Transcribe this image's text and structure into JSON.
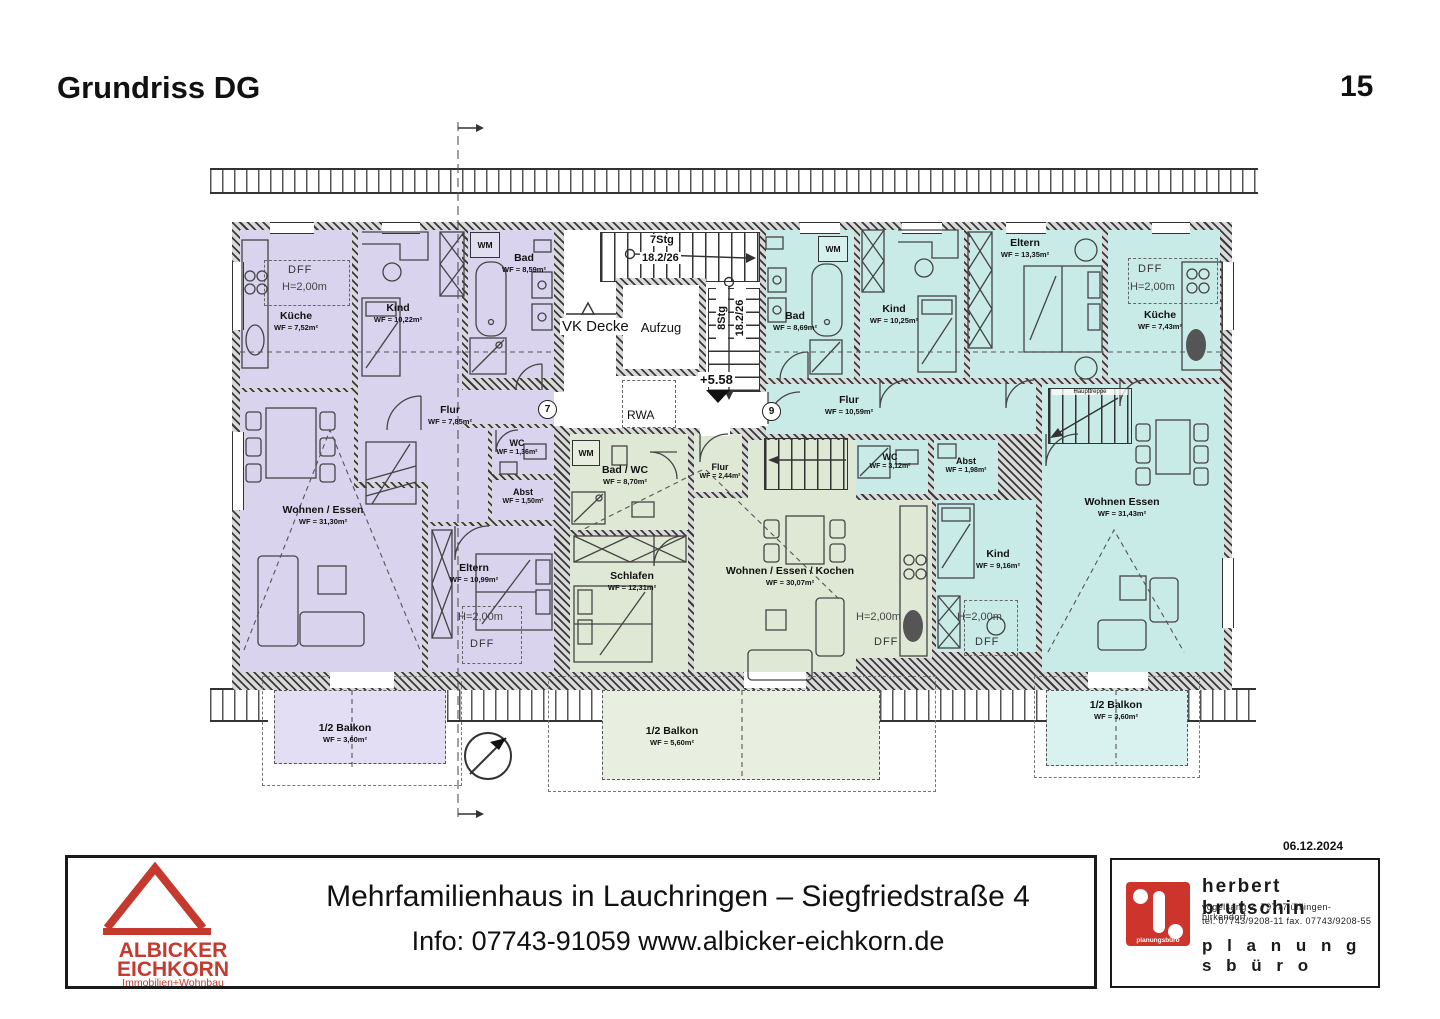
{
  "header": {
    "title": "Grundriss DG",
    "page_number": "15"
  },
  "plan": {
    "rooms": {
      "a7_kueche": {
        "name": "Küche",
        "area": "WF = 7,52m²"
      },
      "a7_kind": {
        "name": "Kind",
        "area": "WF = 10,22m²"
      },
      "a7_bad": {
        "name": "Bad",
        "area": "WF = 8,59m²"
      },
      "a7_flur": {
        "name": "Flur",
        "area": "WF = 7,85m²"
      },
      "a7_wc": {
        "name": "WC",
        "area": "WF = 1,36m²"
      },
      "a7_abst": {
        "name": "Abst",
        "area": "WF = 1,50m²"
      },
      "a7_wohnen": {
        "name": "Wohnen / Essen",
        "area": "WF = 31,30m²"
      },
      "a7_eltern": {
        "name": "Eltern",
        "area": "WF = 10,99m²"
      },
      "a7_balkon": {
        "name": "1/2 Balkon",
        "area": "WF = 3,60m²"
      },
      "a8_bad": {
        "name": "Bad / WC",
        "area": "WF = 8,70m²"
      },
      "a8_schlafen": {
        "name": "Schlafen",
        "area": "WF = 12,31m²"
      },
      "a8_flur": {
        "name": "Flur",
        "area": "WF = 2,44m²"
      },
      "a8_wohnen": {
        "name": "Wohnen / Essen / Kochen",
        "area": "WF = 30,07m²"
      },
      "a8_balkon": {
        "name": "1/2 Balkon",
        "area": "WF = 5,60m²"
      },
      "a9_bad": {
        "name": "Bad",
        "area": "WF = 8,69m²"
      },
      "a9_kind1": {
        "name": "Kind",
        "area": "WF = 10,25m²"
      },
      "a9_eltern": {
        "name": "Eltern",
        "area": "WF = 13,35m²"
      },
      "a9_kueche": {
        "name": "Küche",
        "area": "WF = 7,43m²"
      },
      "a9_flur": {
        "name": "Flur",
        "area": "WF = 10,59m²"
      },
      "a9_wc": {
        "name": "WC",
        "area": "WF = 3,12m²"
      },
      "a9_abst": {
        "name": "Abst",
        "area": "WF = 1,98m²"
      },
      "a9_kind2": {
        "name": "Kind",
        "area": "WF = 9,16m²"
      },
      "a9_wohnen": {
        "name": "Wohnen Essen",
        "area": "WF = 31,43m²"
      },
      "a9_balkon": {
        "name": "1/2 Balkon",
        "area": "WF = 3,60m²"
      }
    },
    "annotations": {
      "dff": "DFF",
      "h200": "H=2,00m",
      "wm": "WM",
      "vk_decke": "VK Decke",
      "aufzug": "Aufzug",
      "rwa": "RWA",
      "stairs7": "7Stg",
      "stairs7_dim": "18.2/26",
      "stairs8": "8Stg",
      "stairs8_dim": "18.2/26",
      "level": "+5.58",
      "haupttreppe": "Haupttreppe",
      "apt_left_number": "7",
      "apt_right_number": "9"
    },
    "colors": {
      "apartment_left": "#d9d3ee",
      "apartment_middle": "#dfe8d5",
      "apartment_right": "#c9ebe7",
      "balcony_left": "#e4def5",
      "balcony_middle": "#e9efe0",
      "balcony_right": "#d9f2ef",
      "logo_red": "#cc342c"
    }
  },
  "footer": {
    "date": "06.12.2024",
    "title": "Mehrfamilienhaus in Lauchringen – Siegfriedstraße 4",
    "info": "Info: 07743-91059 www.albicker-eichkorn.de",
    "agency": {
      "line1": "ALBICKER",
      "line2": "EICHKORN",
      "line3": "Immobilien+Wohnbau"
    },
    "planner": {
      "name": "herbert  brutschin",
      "address": "vogelsang 2, 79777 ühlingen-birkendorf",
      "phone": "tel. 07743/9208-11  fax. 07743/9208-55",
      "label": "p l a n u n g s b ü r o",
      "logo_text": "planungsbüro"
    }
  }
}
